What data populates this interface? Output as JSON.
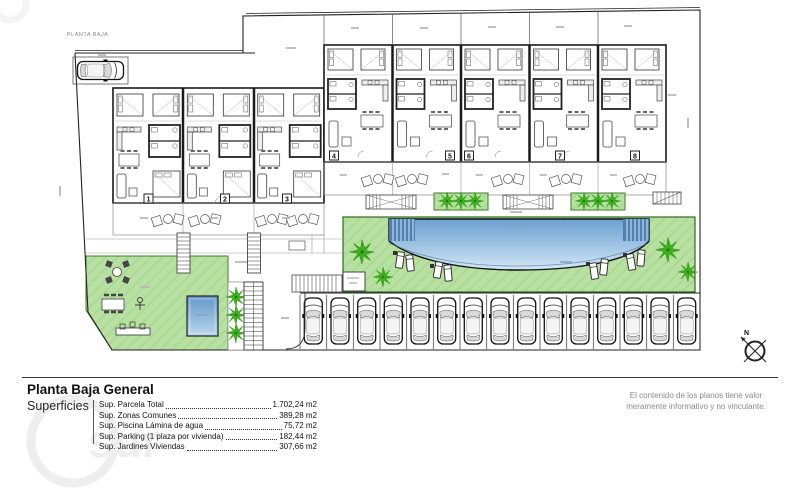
{
  "page": {
    "title": "PLANTA BAJA"
  },
  "plan": {
    "units": [
      "1",
      "2",
      "3",
      "4",
      "5",
      "6",
      "7",
      "8"
    ],
    "compass_label": "N"
  },
  "footer": {
    "heading": "Planta Baja General",
    "superficies_label": "Superficies",
    "surfaces": [
      {
        "label": "Sup. Parcela Total",
        "value": "1.702,24 m2"
      },
      {
        "label": "Sup. Zonas Comunes",
        "value": "389,28 m2"
      },
      {
        "label": "Sup. Piscina Lámina de agua",
        "value": "75,72 m2"
      },
      {
        "label": "Sup. Parking (1 plaza por vivienda)",
        "value": "182,44 m2"
      },
      {
        "label": "Sup. Jardines Viviendas",
        "value": "307,66 m2"
      }
    ],
    "disclaimer": [
      "El contenido de los planos tiene valor",
      "meramente informativo y no vinculante."
    ]
  },
  "watermark_text": "sur",
  "colors": {
    "lawn": "#b7e0a2",
    "lawn_hatch": "#a8d78e",
    "lawn_border": "#3e7d2b",
    "palm": "#3cb11d",
    "pool_deep": "#6ba0d0",
    "pool_shallow": "#d3e8f6",
    "line": "#1a1a1a"
  }
}
